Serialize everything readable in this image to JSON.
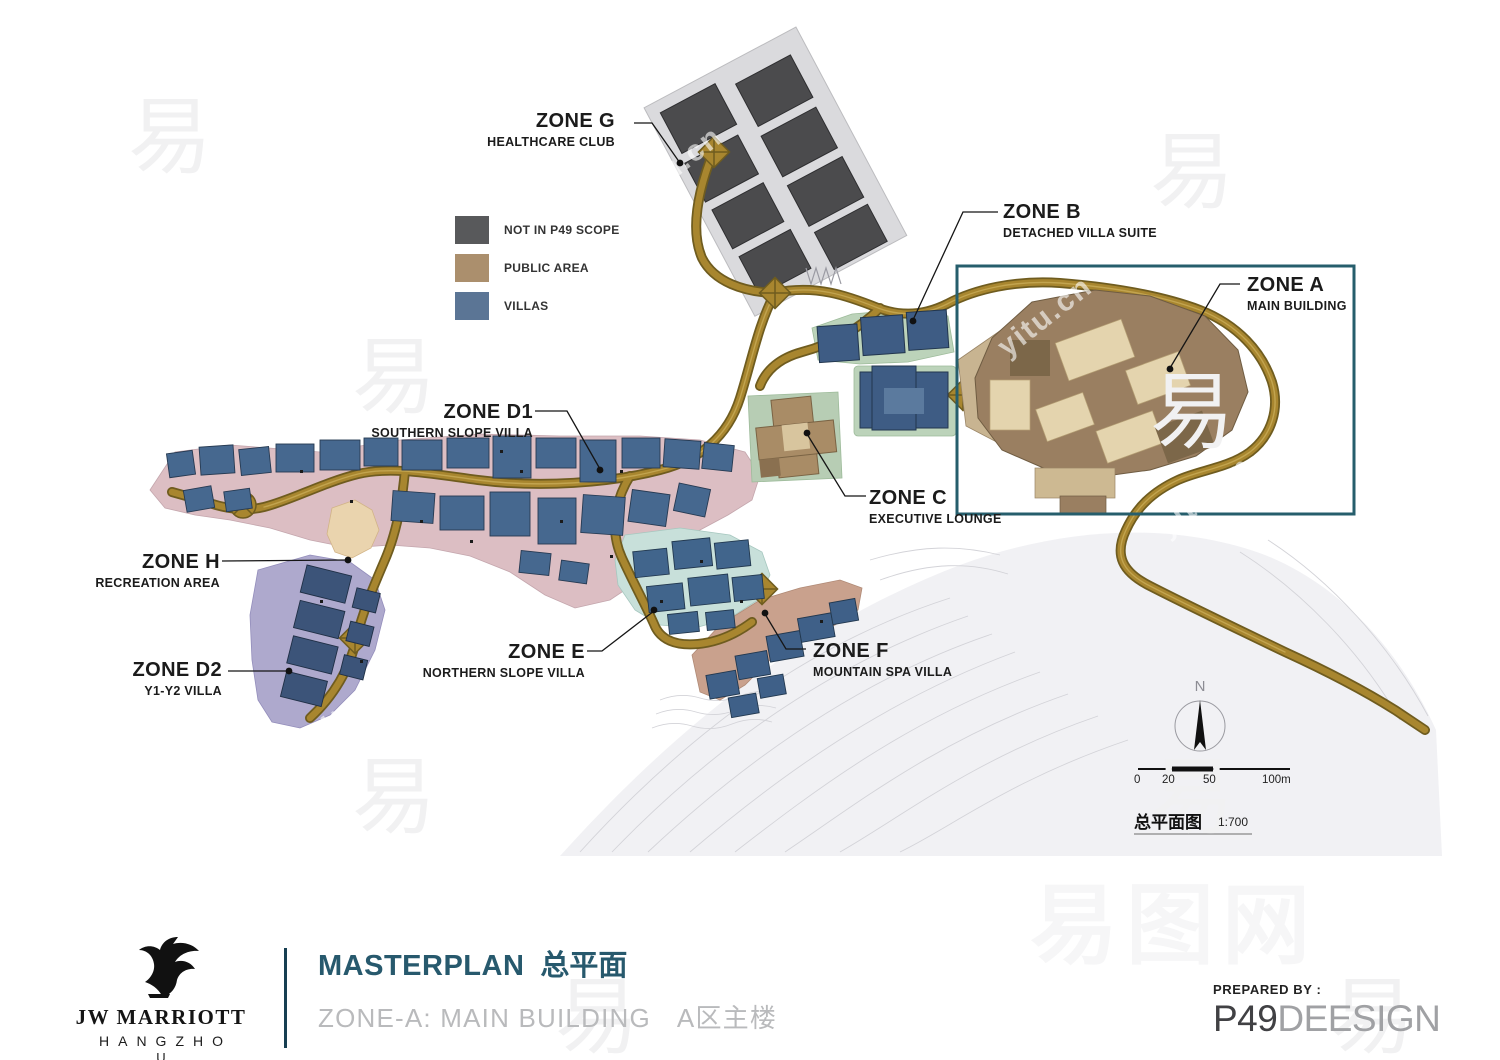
{
  "map": {
    "zones": [
      {
        "id": "G",
        "name": "ZONE G",
        "subtitle": "HEALTHCARE CLUB"
      },
      {
        "id": "B",
        "name": "ZONE B",
        "subtitle": "DETACHED VILLA SUITE"
      },
      {
        "id": "A",
        "name": "ZONE A",
        "subtitle": "MAIN BUILDING"
      },
      {
        "id": "D1",
        "name": "ZONE D1",
        "subtitle": "SOUTHERN SLOPE VILLA"
      },
      {
        "id": "C",
        "name": "ZONE C",
        "subtitle": "EXECUTIVE LOUNGE"
      },
      {
        "id": "H",
        "name": "ZONE H",
        "subtitle": "RECREATION AREA"
      },
      {
        "id": "D2",
        "name": "ZONE D2",
        "subtitle": "Y1-Y2 VILLA"
      },
      {
        "id": "E",
        "name": "ZONE E",
        "subtitle": "NORTHERN SLOPE VILLA"
      },
      {
        "id": "F",
        "name": "ZONE F",
        "subtitle": "MOUNTAIN SPA VILLA"
      }
    ],
    "legend": {
      "items": [
        {
          "label": "NOT IN P49 SCOPE",
          "color": "#58595b"
        },
        {
          "label": "PUBLIC AREA",
          "color": "#ab8f6d"
        },
        {
          "label": "VILLAS",
          "color": "#5b7595"
        }
      ]
    },
    "north_label": "N",
    "scale_bar": {
      "ticks": [
        "0",
        "20",
        "50",
        "100m"
      ]
    },
    "plan_caption": {
      "text": "总平面图",
      "ratio": "1:700"
    }
  },
  "footer": {
    "logo": {
      "brand": "JW MARRIOTT",
      "city_line1": "HANGZHO",
      "city_line2": "U"
    },
    "title_en": "MASTERPLAN",
    "title_cn": "总平面",
    "subtitle_en": "ZONE-A: MAIN BUILDING",
    "subtitle_cn": "A区主楼",
    "prepared_by": "PREPARED BY :",
    "firm_bold": "P49",
    "firm_light": "DEESIGN"
  },
  "watermark": {
    "site_cn": "易图网",
    "site_char": "易",
    "site_url": "yitu.cn"
  },
  "colors": {
    "accent_teal": "#27596d",
    "highlight_box": "#265e6c",
    "road": "#a8862f",
    "road_edge": "#6f5c1f",
    "zone_d1_bg": "#dcbec3",
    "zone_d2_bg": "#aea9cd",
    "zone_e_bg": "#c8e0da",
    "zone_f_bg": "#c9a18d",
    "zone_b_bg": "#bcd3ba",
    "zone_a_building": "#9a7f61",
    "villa_building": "#46688f",
    "not_in_scope_building": "#4b4b4d"
  }
}
